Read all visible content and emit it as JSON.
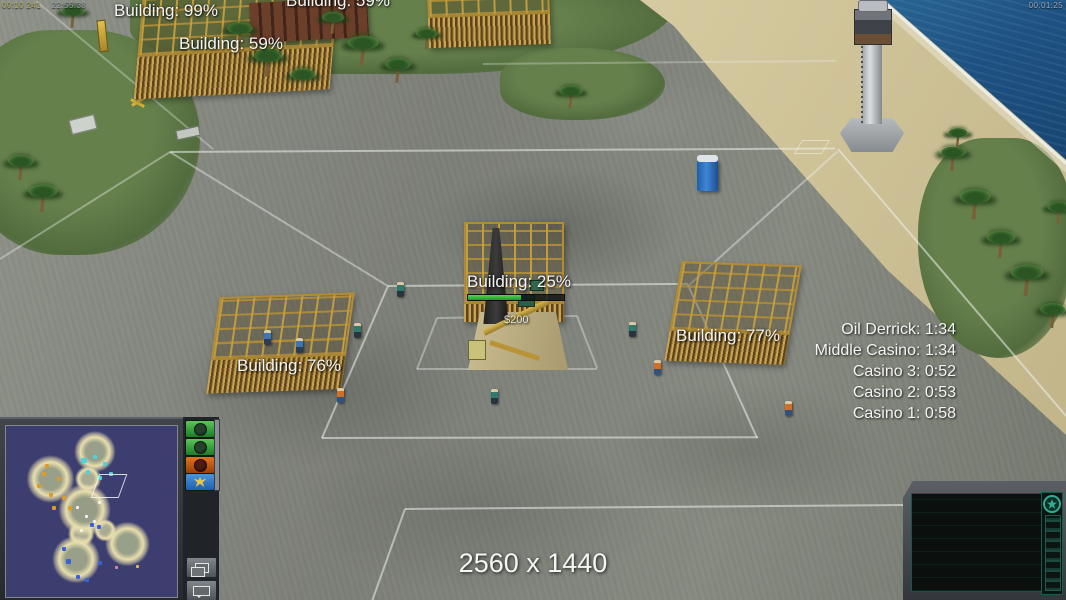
{
  "hud": {
    "top_left": {
      "timer": "00:10 241",
      "clock": "22:55:38"
    },
    "top_right_timer": "00:01:25",
    "resolution_label": "2560 x 1440"
  },
  "building_labels": {
    "top_a": "Building: 99%",
    "top_b": "Building: 59%",
    "top_c": "Building: 59%",
    "center": "Building: 25%",
    "left": "Building: 76%",
    "right": "Building: 77%"
  },
  "price_tag": "$200",
  "build_progress": {
    "center_label_pct": 25,
    "bar_display_pct": 55
  },
  "countdowns": {
    "items": [
      "Oil Derrick: 1:34",
      "Middle Casino: 1:34",
      "Casino 3: 0:52",
      "Casino 2: 0:53",
      "Casino 1: 0:58"
    ]
  },
  "observer_sidebar": {
    "buttons": [
      {
        "icon": "player-emblem-icon",
        "color": "#2e9e3a"
      },
      {
        "icon": "player-emblem-icon",
        "color": "#2e9e3a"
      },
      {
        "icon": "player-emblem-icon",
        "color": "#c05a18"
      },
      {
        "icon": "usa-eagle-icon",
        "color": "#2f7fd0"
      }
    ],
    "tool_buttons": [
      {
        "icon": "windows-icon"
      },
      {
        "icon": "chat-icon"
      }
    ]
  },
  "command_panel": {
    "icon": "rank-star-icon"
  },
  "minimap": {
    "water_color": "#3b3e6e",
    "land_color": "#99a089",
    "shore_color": "#e9dfae",
    "blip_colors": {
      "enemy": "#e09a28",
      "ally": "#4fd2d8",
      "neutral": "#f2f2f2",
      "player": "#3b62d6"
    }
  },
  "colors": {
    "hud_accent_teal": "#2fae94",
    "ocean": "#1d5181",
    "scaffold_gold": "#c69e3e",
    "label_text": "#f4f4f2"
  }
}
